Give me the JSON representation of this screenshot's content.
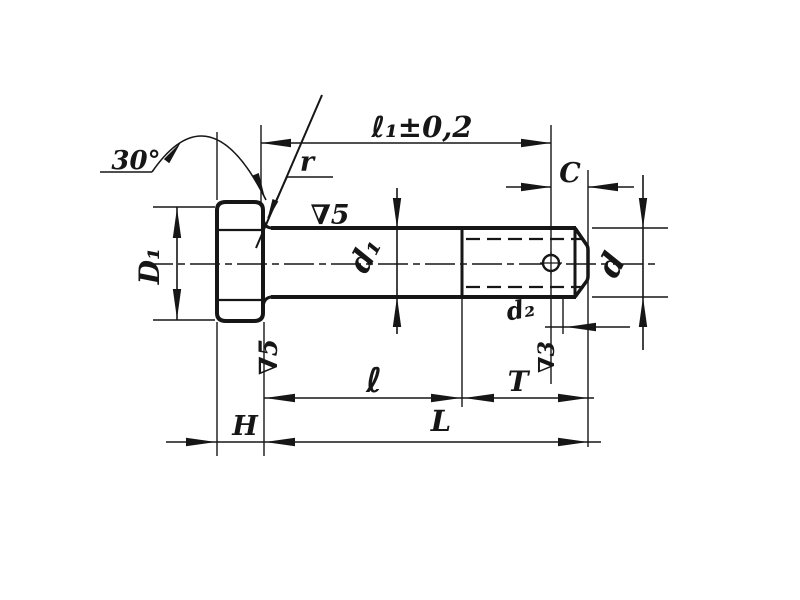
{
  "drawing": {
    "labels": {
      "head_chamfer_angle": "30°",
      "fillet_radius": "r",
      "hole_position_length": "ℓ₁±0,2",
      "end_chamfer": "C",
      "finish_shank_top": "∇5",
      "head_diameter": "D₁",
      "shank_diameter": "d₁",
      "end_diameter": "d",
      "hole_diameter": "d₂",
      "finish_shank_side": "∇5",
      "finish_thread": "∇3",
      "shank_length": "ℓ",
      "thread_length": "T",
      "head_height": "H",
      "total_length": "L"
    }
  }
}
